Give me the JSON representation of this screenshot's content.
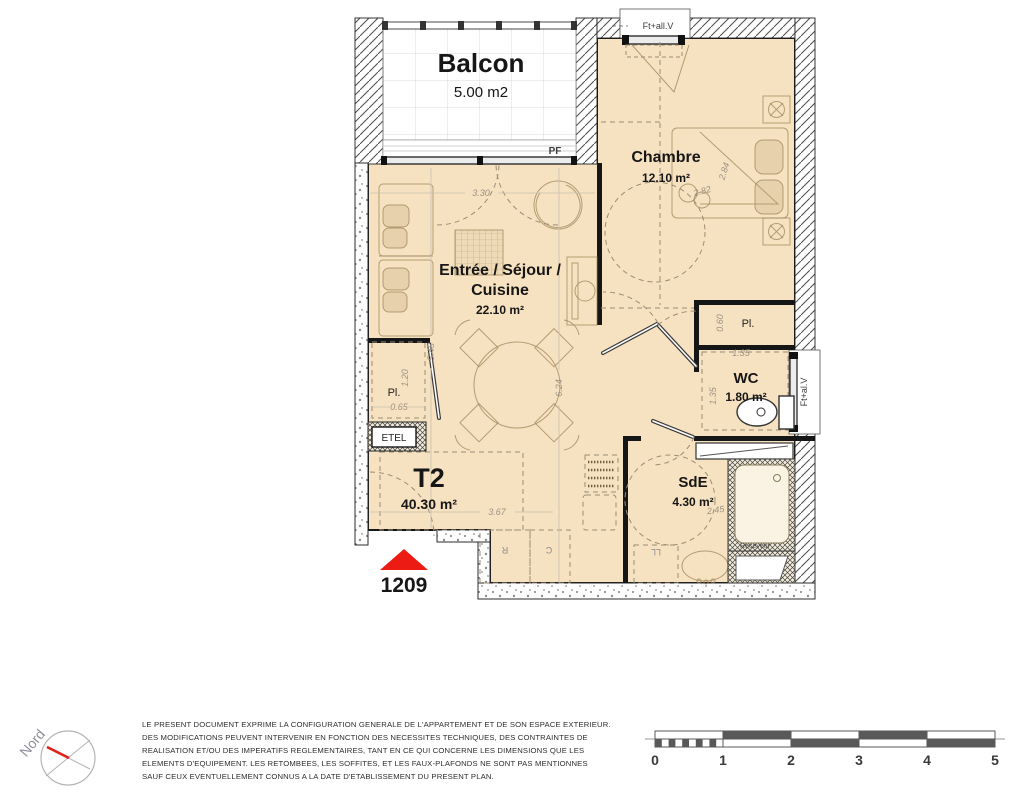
{
  "plan": {
    "unit": {
      "type": "T2",
      "area": "40.30 m²",
      "number": "1209"
    },
    "rooms": {
      "balcon": {
        "name": "Balcon",
        "area": "5.00 m2"
      },
      "chambre": {
        "name": "Chambre",
        "area": "12.10 m²"
      },
      "sejour": {
        "line1": "Entrée / Séjour /",
        "line2": "Cuisine",
        "area": "22.10 m²"
      },
      "wc": {
        "name": "WC",
        "area": "1.80 m²"
      },
      "sde": {
        "name": "SdE",
        "area": "4.30 m²"
      },
      "pl_left": {
        "name": "Pl."
      },
      "pl_right": {
        "name": "Pl."
      }
    },
    "labels": {
      "etel": "ETEL",
      "pf": "PF",
      "window_top": "Ft+all.V",
      "window_wc": "Ft+al.V",
      "receveur": "Receveur",
      "ll": "LL",
      "r": "R",
      "c": "C"
    },
    "dims": {
      "d330": "3.30",
      "d545": "5.45",
      "d624": "6.24",
      "d367": "3.67",
      "d120": "1.20",
      "d065": "0.65",
      "d060": "0.60",
      "d135a": "1.35",
      "d135b": "1.35",
      "d245": "2.45",
      "d284": "2.84",
      "d282": "2.82"
    }
  },
  "compass": {
    "label": "Nord"
  },
  "scalebar": {
    "ticks": [
      "0",
      "1",
      "2",
      "3",
      "4",
      "5"
    ]
  },
  "disclaimer": {
    "lines": [
      "LE PRESENT DOCUMENT EXPRIME LA CONFIGURATION GENERALE DE L'APPARTEMENT ET DE SON ESPACE EXTERIEUR.",
      "DES MODIFICATIONS PEUVENT INTERVENIR EN FONCTION DES NECESSITES TECHNIQUES, DES CONTRAINTES DE",
      "REALISATION ET/OU DES IMPERATIFS REGLEMENTAIRES, TANT EN CE QUI CONCERNE LES DIMENSIONS QUE LES",
      "ELEMENTS D'EQUIPEMENT. LES RETOMBEES, LES SOFFITES, ET LES FAUX-PLAFONDS NE SONT PAS MENTIONNES",
      "SAUF CEUX EVENTUELLEMENT CONNUS A LA DATE D'ETABLISSEMENT DU PRESENT PLAN."
    ]
  },
  "colors": {
    "floor": "#F6E2C0",
    "arrow_red": "#EC1C14",
    "scalebar_dark": "#595959"
  }
}
